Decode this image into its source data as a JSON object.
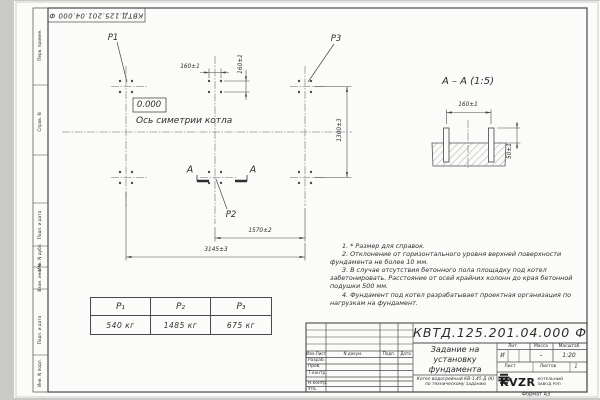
{
  "stamp_top": "КВТД.125.201.04.000 Ф",
  "sidebar": {
    "labels": [
      "Перв. примен.",
      "Справ. N",
      "Подп. и дата",
      "Инв. N дубл.",
      "Взам. инв. N",
      "Подп. и дата",
      "Инв. N подл."
    ]
  },
  "plan": {
    "p1": "P1",
    "p2": "P2",
    "p3": "P3",
    "elevation": "0.000",
    "axis_label": "Ось симетрии котла",
    "dim_160_h": "160±1",
    "dim_160_v": "160±1",
    "dim_1300": "1300±3",
    "dim_1570": "1570±2",
    "dim_3145": "3145±3",
    "cut_letter": "А"
  },
  "section": {
    "title": "А – А (1:5)",
    "dim_160": "160±1",
    "dim_50": "50±1"
  },
  "notes": [
    "1. * Размер для справок.",
    "2. Отклонение от горизонтального уровня верхней поверхности фундамента не более 10 мм.",
    "3. В случае отсутствия бетонного пола площадку под котел забетонировать. Расстояние от осей крайних колонн до края бетонной подушки 500 мм.",
    "4. Фундамент под котел разрабатывает проектная организация по нагрузкам на фундамент."
  ],
  "load_table": {
    "headers": [
      "P₁",
      "P₂",
      "P₃"
    ],
    "values": [
      "540 кг",
      "1485 кг",
      "675 кг"
    ]
  },
  "title_block": {
    "designation": "КВТД.125.201.04.000 Ф",
    "doc_title": "Задание на установку фундамента",
    "object_desc": "Котел водогрейный КВ-1,45 Д (К) по техническому заданию",
    "col_headers": [
      "Изм.Лист",
      "N докум.",
      "Подп.",
      "Дата"
    ],
    "row_labels": [
      "Разраб.",
      "Пров.",
      "Т.контр.",
      "Н.контр.",
      "Утв."
    ],
    "lit_header": "Лит.",
    "mass_header": "Масса",
    "scale_header": "Масштаб",
    "lit_value": "И",
    "mass_value": "–",
    "scale_value": "1:20",
    "sheet_label": "Лист",
    "sheets_label": "Листов",
    "sheets_value": "1",
    "company": "KVZR",
    "company_desc": "КОТЕЛЬНЫЙ ЗАВОД РЭП",
    "format_label": "Формат А3"
  }
}
